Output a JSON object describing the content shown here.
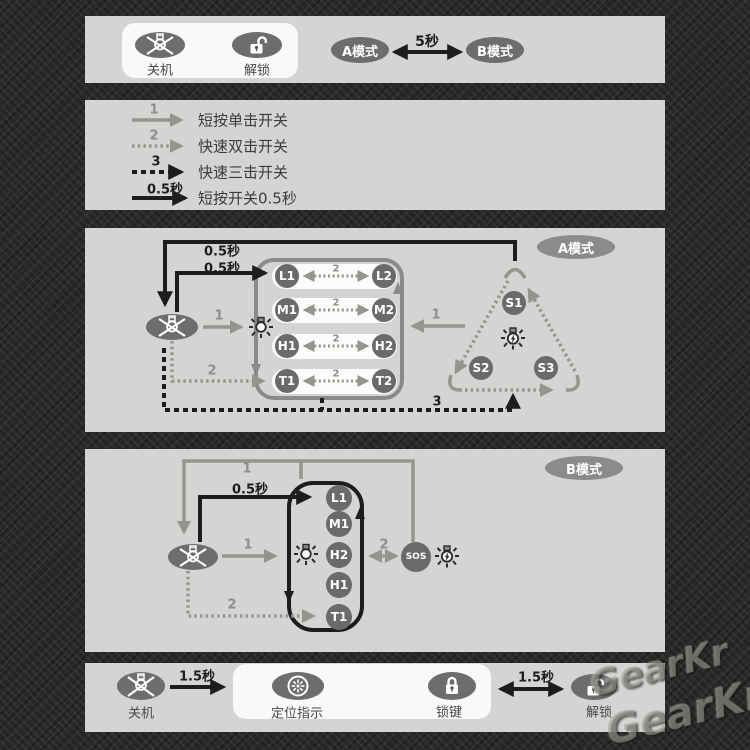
{
  "power_panel": {
    "off_label": "关机",
    "unlock_label": "解锁",
    "mode_a": "A模式",
    "hold": "5秒",
    "mode_b": "B模式"
  },
  "legend": {
    "rows": [
      {
        "key": "1",
        "label": "短按单击开关"
      },
      {
        "key": "2",
        "label": "快速双击开关"
      },
      {
        "key": "3",
        "label": "快速三击开关"
      },
      {
        "key": "0.5秒",
        "label": "短按开关0.5秒"
      }
    ]
  },
  "mode_a": {
    "badge": "A模式",
    "hold_top": "0.5秒",
    "hold_to_l1": "0.5秒",
    "press_on": "1",
    "press_t": "2",
    "pair_key": "2",
    "press_back": "1",
    "press_strobe": "3",
    "rows": [
      {
        "left": "L1",
        "right": "L2"
      },
      {
        "left": "M1",
        "right": "M2"
      },
      {
        "left": "H1",
        "right": "H2"
      },
      {
        "left": "T1",
        "right": "T2"
      }
    ],
    "strobe": {
      "s1": "S1",
      "s2": "S2",
      "s3": "S3"
    }
  },
  "mode_b": {
    "badge": "B模式",
    "loop_key": "1",
    "hold_to_l1": "0.5秒",
    "press_on": "1",
    "press_t": "2",
    "sos_key": "2",
    "stack": [
      "L1",
      "M1",
      "H2",
      "H1",
      "T1"
    ],
    "sos": "SOS"
  },
  "lock_panel": {
    "off_label": "关机",
    "hold_left": "1.5秒",
    "beacon_label": "定位指示",
    "lock_label": "锁键",
    "hold_right": "1.5秒",
    "unlock_label": "解锁"
  },
  "watermark": {
    "line1": "GearKr",
    "line2": "GearKr"
  },
  "colors": {
    "background": "#2c2b29",
    "panel": "#d5d4d2",
    "card": "#faf9f7",
    "node": "#6e6d6b",
    "badge": "#8c8b89",
    "gray_line": "#95948f",
    "black_line": "#1d1d1b"
  }
}
